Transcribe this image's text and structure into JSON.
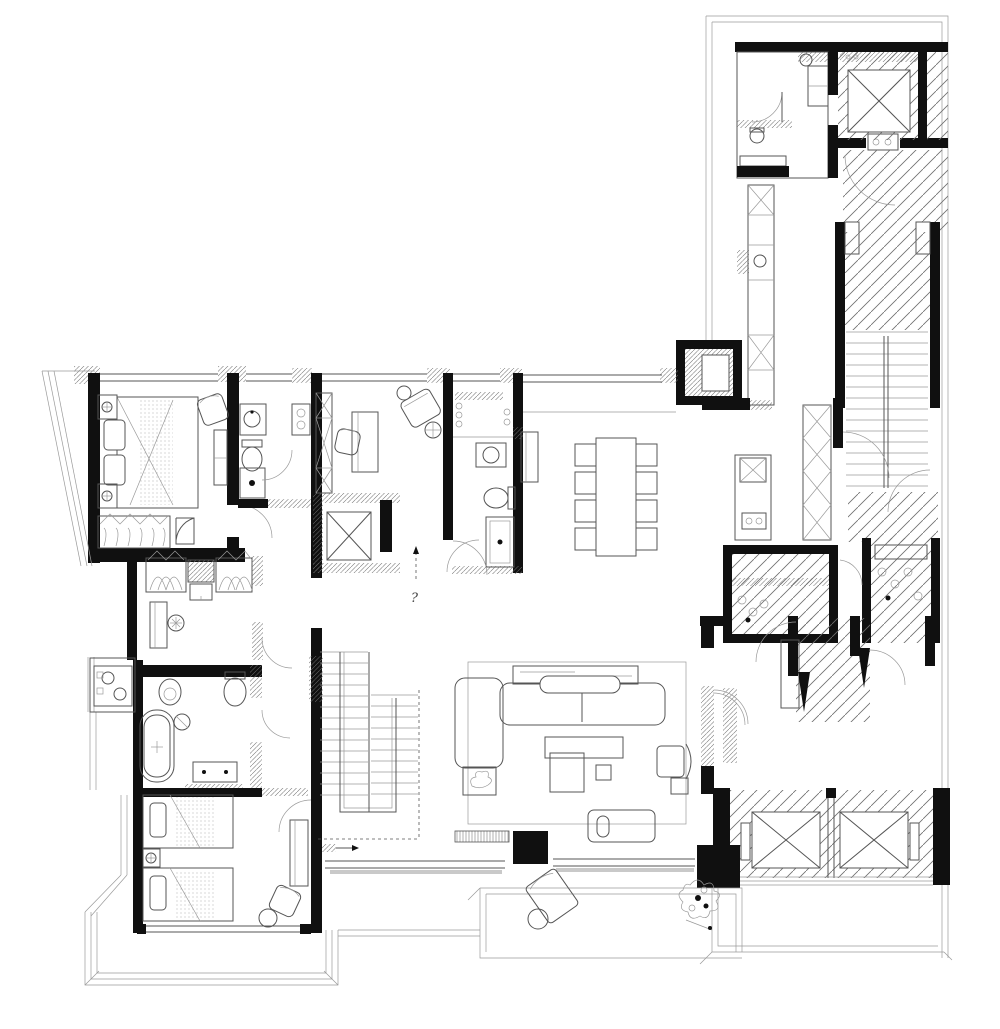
{
  "colors": {
    "background": "#ffffff",
    "wall": "#101010",
    "line": "#555555",
    "lite": "#9a9a9a",
    "hatch": "#6e6e6e",
    "stipple": "#bcbcbc"
  },
  "annotations": {
    "stair_note": "?"
  },
  "counts": {
    "dining_chairs": 8,
    "elevator_cars": 2,
    "twin_beds": 2
  }
}
